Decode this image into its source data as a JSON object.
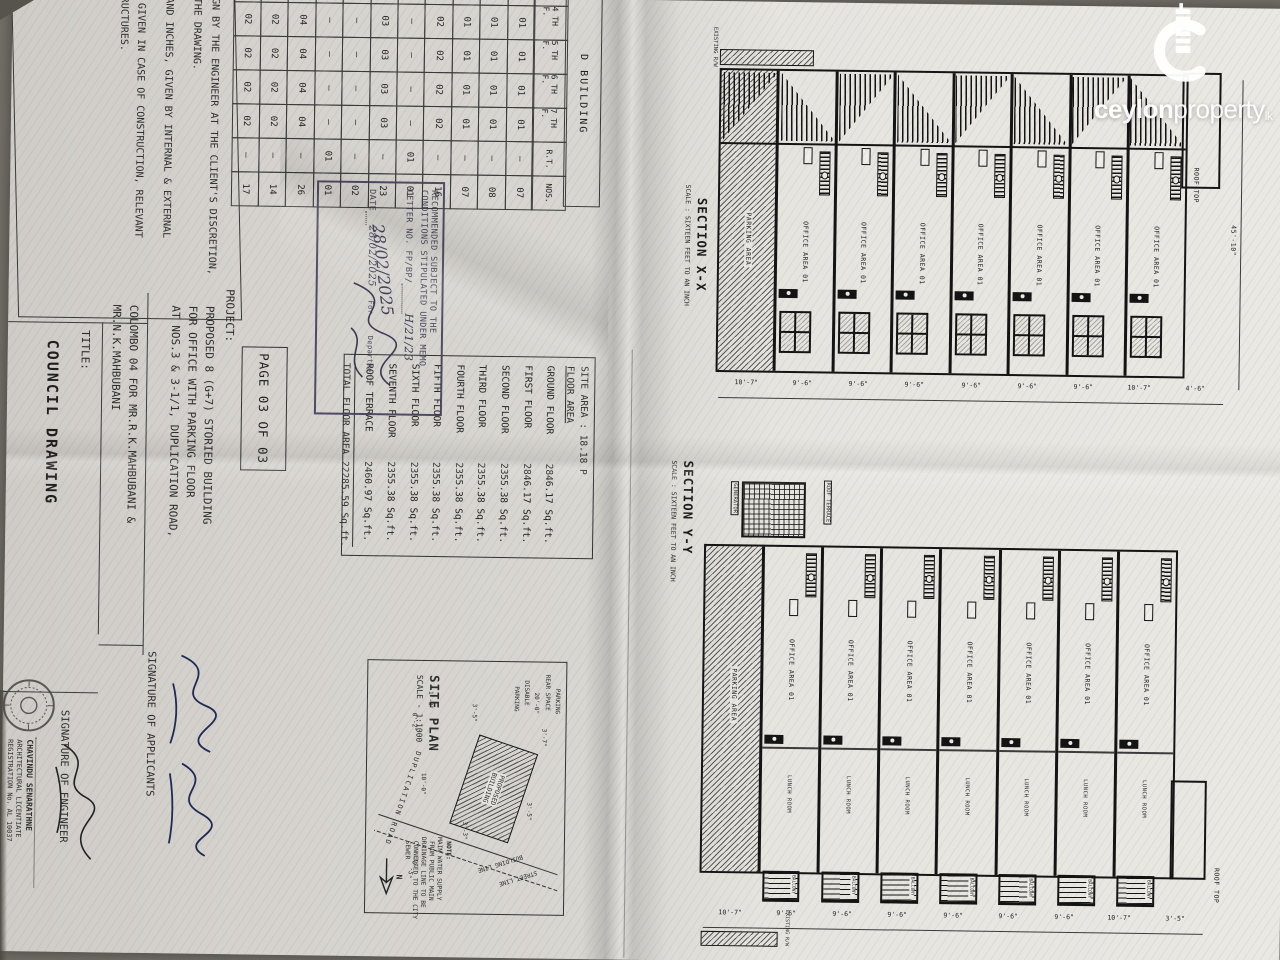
{
  "logo": {
    "brand_bold": "ceylon",
    "brand_light": "property",
    "tld": "lk"
  },
  "page_strip": "PAGE 03 OF 03",
  "notes": {
    "lines": [
      "SIGN BY THE ENGINEER AT THE CLIENT'S DISCRETION,",
      "N THE DRAWING.",
      "T AND INCHES, GIVEN BY INTERNAL & EXTERNAL",
      "LS GIVEN IN CASE OF CONSTRUCTION, RELEVANT",
      "STRUCTURES."
    ]
  },
  "building_table": {
    "title": "D BUILDING",
    "header_rows": [
      [
        "3 RD F.",
        "4 TH F.",
        "5 TH F.",
        "6 TH F.",
        "7 TH F.",
        "R.T.",
        "NOS."
      ]
    ],
    "rows": [
      [
        "01",
        "01",
        "01",
        "01",
        "01",
        "–",
        "07"
      ],
      [
        "01",
        "01",
        "01",
        "01",
        "01",
        "–",
        "08"
      ],
      [
        "01",
        "01",
        "01",
        "01",
        "01",
        "–",
        "07"
      ],
      [
        "02",
        "02",
        "02",
        "02",
        "02",
        "–",
        "16"
      ],
      [
        "–",
        "–",
        "–",
        "–",
        "–",
        "01",
        "01"
      ],
      [
        "03",
        "03",
        "03",
        "03",
        "03",
        "–",
        "23"
      ],
      [
        "–",
        "–",
        "–",
        "–",
        "–",
        "–",
        "02"
      ],
      [
        "–",
        "–",
        "–",
        "–",
        "–",
        "01",
        "01"
      ],
      [
        "04",
        "04",
        "04",
        "04",
        "04",
        "–",
        "26"
      ],
      [
        "02",
        "02",
        "02",
        "02",
        "02",
        "–",
        "14"
      ],
      [
        "02",
        "02",
        "02",
        "02",
        "02",
        "–",
        "17"
      ]
    ]
  },
  "area_table": {
    "site_area": "SITE AREA : 18.18 P",
    "heading": "FLOOR AREA",
    "rows": [
      [
        "GROUND FLOOR",
        "2846.17 Sq.ft."
      ],
      [
        "FIRST FLOOR",
        "2846.17 Sq.ft."
      ],
      [
        "SECOND FLOOR",
        "2355.38 Sq.ft."
      ],
      [
        "THIRD FLOOR",
        "2355.38 Sq.ft."
      ],
      [
        "FOURTH FLOOR",
        "2355.38 Sq.ft."
      ],
      [
        "FIFTH FLOOR",
        "2355.38 Sq.ft."
      ],
      [
        "SIXTH FLOOR",
        "2355.38 Sq.ft."
      ],
      [
        "SEVENTH FLOOR",
        "2355.38 Sq.ft."
      ],
      [
        "ROOF TERRACE",
        "2460.97 Sq.ft."
      ]
    ],
    "total_label": "TOTAL FLOOR AREA",
    "total_value": "22285.59 Sq.ft."
  },
  "stamp": {
    "line1": "RECOMMENDED SUBJECT TO THE",
    "line2": "CONDITIONS STIPULATED UNDER MEMO",
    "line3": "LETTER NO. FP/BP/",
    "letter_no": "H/21/23",
    "date_hand": "28/02/2025",
    "date_label": "DATE",
    "date_value": "28/02/2025",
    "for_label": "For",
    "dept": "Department"
  },
  "project": {
    "label": "PROJECT:",
    "lines": [
      "PROPOSED 8 (G+7) STORIED BUILDING",
      "FOR OFFICE WITH PARKING FLOOR",
      "AT NOS.3 & 3-1/1, DUPLICATION ROAD,",
      "COLOMBO 04 FOR MR.R.K.MAHBUBANI &",
      "MR.N.K.MAHBUBANI"
    ]
  },
  "title_block": {
    "label": "TITLE:",
    "value": "COUNCIL DRAWING"
  },
  "signatures": {
    "applicants_label": "SIGNATURE OF APPLICANTS",
    "engineer_label": "SIGNATURE OF ENGINEER",
    "engineer_name": "CHAVINDU SENARATHNE",
    "engineer_title": "ARCHITECTURAL LICENTIATE",
    "engineer_reg": "REGISTRATION No. AL 10037"
  },
  "section_xx": {
    "title": "SECTION X-X",
    "scale": "SCALE : SIXTEEN FEET TO AN INCH",
    "labels": {
      "office": "OFFICE AREA 01",
      "parking": "PARKING AREA",
      "roof_top": "ROOF TOP",
      "existing": "EXISTING R/W",
      "height": "45'-10\""
    },
    "dims": [
      "4'-6\"",
      "10'-7\"",
      "9'-6\"",
      "9'-6\"",
      "9'-6\"",
      "9'-6\"",
      "9'-6\"",
      "9'-6\"",
      "10'-7\""
    ]
  },
  "section_yy": {
    "title": "SECTION Y-Y",
    "scale": "SCALE : SIXTEEN FEET TO AN INCH",
    "labels": {
      "office": "OFFICE AREA 01",
      "lunch": "LUNCH ROOM",
      "balcony": "BALCONY",
      "parking": "PARKING AREA",
      "roof_terrace": "ROOF TERRACE",
      "generator": "GENERATOR",
      "roof_top": "ROOF TOP",
      "existing": "EXISTING R/W"
    },
    "dims": [
      "3'-5\"",
      "10'-7\"",
      "9'-6\"",
      "9'-6\"",
      "9'-6\"",
      "9'-6\"",
      "9'-6\"",
      "9'-6\"",
      "10'-7\""
    ]
  },
  "site_plan": {
    "title": "SITE PLAN",
    "scale": "SCALE - 1:1000",
    "building_l1": "PROPOSED",
    "building_l2": "BUILDING",
    "road": "DUPLICATION ROAD",
    "street_line": "STREET LINE",
    "building_line": "BUILDING LINE",
    "parking": "PARKING",
    "rear_space": "REAR SPACE",
    "disable_1": "20'-0\"",
    "disable_2": "DISABLE",
    "disable_3": "PARKING",
    "north": "N",
    "note_lines": [
      "NOTE:",
      "MAIN WATER SUPPLY",
      "FROM PUBLIC MAIN",
      "DRAINAGE LINE TO BE",
      "CONNECTED TO THE CITY",
      "SEWER"
    ],
    "dims": {
      "d1": "3'-7\"",
      "d2": "3'-5\"",
      "d3": "3'-3\"",
      "d4": "3'-5\"",
      "d5": "1'-0\"",
      "d6": "0'-2\"",
      "d7": "10'-0\"",
      "d8": "30'-5\""
    }
  }
}
